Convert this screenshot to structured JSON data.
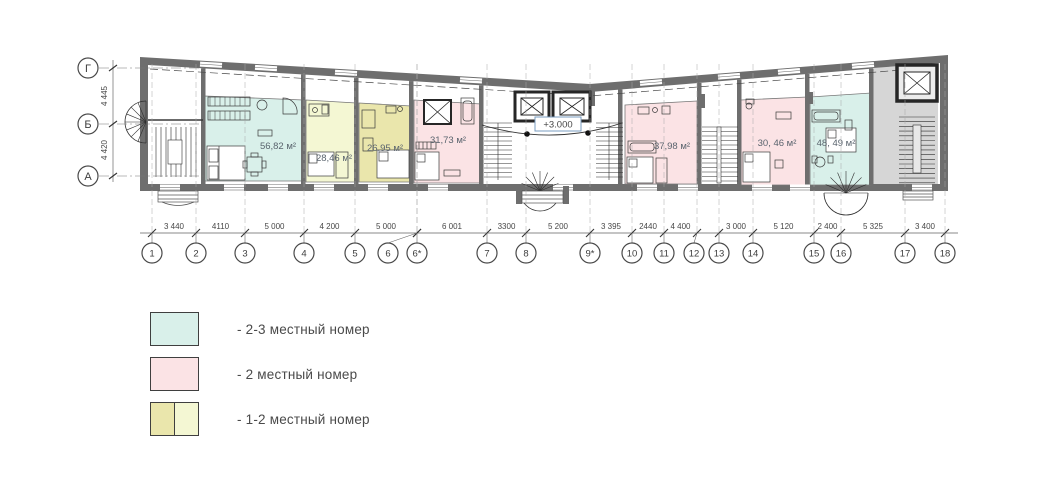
{
  "colors": {
    "teal": "#d9f0ea",
    "pink": "#fbe3e5",
    "yellow_dark": "#eae6ac",
    "yellow_light": "#f4f7d3",
    "wall": "#6e6e6e",
    "gray_block": "#d6d6d6",
    "elevation_border": "#7a9cc0",
    "area_text": "#5a646e",
    "dim_text": "#474747"
  },
  "plan": {
    "elevation_label": "+3.000",
    "rooms": [
      {
        "area": "56,82 м²",
        "color": "teal",
        "x1": 205,
        "x2": 303,
        "yt1": 96,
        "yt2": 100,
        "yb": 181,
        "lx": 278,
        "ly": 149
      },
      {
        "area": "28,46 м²",
        "color": "yellow_light",
        "x1": 306,
        "x2": 356,
        "yt1": 100,
        "yt2": 103,
        "yb": 182,
        "lx": 334,
        "ly": 161
      },
      {
        "area": "26,95 м²",
        "color": "yellow_dark",
        "x1": 359,
        "x2": 411,
        "yt1": 103,
        "yt2": 106,
        "yb": 182,
        "lx": 385,
        "ly": 151
      },
      {
        "area": "31,73 м²",
        "color": "pink",
        "x1": 414,
        "x2": 481,
        "yt1": 100,
        "yt2": 104,
        "yb": 183,
        "lx": 448,
        "ly": 143
      },
      {
        "area": "37,98 м²",
        "color": "pink",
        "x1": 625,
        "x2": 697,
        "yt1": 105,
        "yt2": 101,
        "yb": 184,
        "lx": 672,
        "ly": 149
      },
      {
        "area": "30, 46 м²",
        "color": "pink",
        "x1": 741,
        "x2": 807,
        "yt1": 100,
        "yt2": 97,
        "yb": 185,
        "lx": 777,
        "ly": 146
      },
      {
        "area": "48, 49 м²",
        "color": "teal",
        "x1": 810,
        "x2": 871,
        "yt1": 97,
        "yt2": 93,
        "yb": 185,
        "lx": 836,
        "ly": 146
      }
    ],
    "grid_columns": [
      {
        "label": "1",
        "x": 152
      },
      {
        "label": "2",
        "x": 196
      },
      {
        "label": "3",
        "x": 245
      },
      {
        "label": "4",
        "x": 304
      },
      {
        "label": "5",
        "x": 355
      },
      {
        "label": "6",
        "x": 417,
        "bx": 388
      },
      {
        "label": "6*",
        "x": 417
      },
      {
        "label": "7",
        "x": 487
      },
      {
        "label": "8",
        "x": 526
      },
      {
        "label": "9*",
        "x": 590
      },
      {
        "label": "10",
        "x": 632
      },
      {
        "label": "11",
        "x": 664
      },
      {
        "label": "12",
        "x": 697,
        "bx": 694
      },
      {
        "label": "13",
        "x": 719
      },
      {
        "label": "14",
        "x": 753
      },
      {
        "label": "15",
        "x": 814
      },
      {
        "label": "16",
        "x": 841
      },
      {
        "label": "17",
        "x": 905
      },
      {
        "label": "18",
        "x": 945
      }
    ],
    "grid_dims": [
      {
        "value": "3 440",
        "x1": 152,
        "x2": 196
      },
      {
        "value": "4110",
        "x1": 196,
        "x2": 245
      },
      {
        "value": "5 000",
        "x1": 245,
        "x2": 304
      },
      {
        "value": "4 200",
        "x1": 304,
        "x2": 355
      },
      {
        "value": "5 000",
        "x1": 355,
        "x2": 417
      },
      {
        "value": "6 001",
        "x1": 417,
        "x2": 487
      },
      {
        "value": "3300",
        "x1": 487,
        "x2": 526
      },
      {
        "value": "5 200",
        "x1": 526,
        "x2": 590
      },
      {
        "value": "3 395",
        "x1": 590,
        "x2": 632
      },
      {
        "value": "2440",
        "x1": 632,
        "x2": 664
      },
      {
        "value": "4 400",
        "x1": 664,
        "x2": 697
      },
      {
        "value": "3 000",
        "x1": 719,
        "x2": 753
      },
      {
        "value": "5 120",
        "x1": 753,
        "x2": 814
      },
      {
        "value": "2 400",
        "x1": 814,
        "x2": 841
      },
      {
        "value": "5 325",
        "x1": 841,
        "x2": 905
      },
      {
        "value": "3 400",
        "x1": 905,
        "x2": 945
      }
    ],
    "row_axes": [
      {
        "label": "Г",
        "y": 68
      },
      {
        "label": "Б",
        "y": 124
      },
      {
        "label": "А",
        "y": 176
      }
    ],
    "row_dims": [
      {
        "value": "4 445",
        "y1": 68,
        "y2": 124
      },
      {
        "value": "4 420",
        "y1": 124,
        "y2": 176
      }
    ]
  },
  "legend": {
    "items": [
      {
        "label": "- 2-3 местный номер",
        "colors": [
          "#d9f0ea"
        ]
      },
      {
        "label": "- 2 местный номер",
        "colors": [
          "#fbe3e5"
        ]
      },
      {
        "label": "- 1-2 местный номер",
        "colors": [
          "#eae6ac",
          "#f4f7d3"
        ]
      }
    ]
  }
}
